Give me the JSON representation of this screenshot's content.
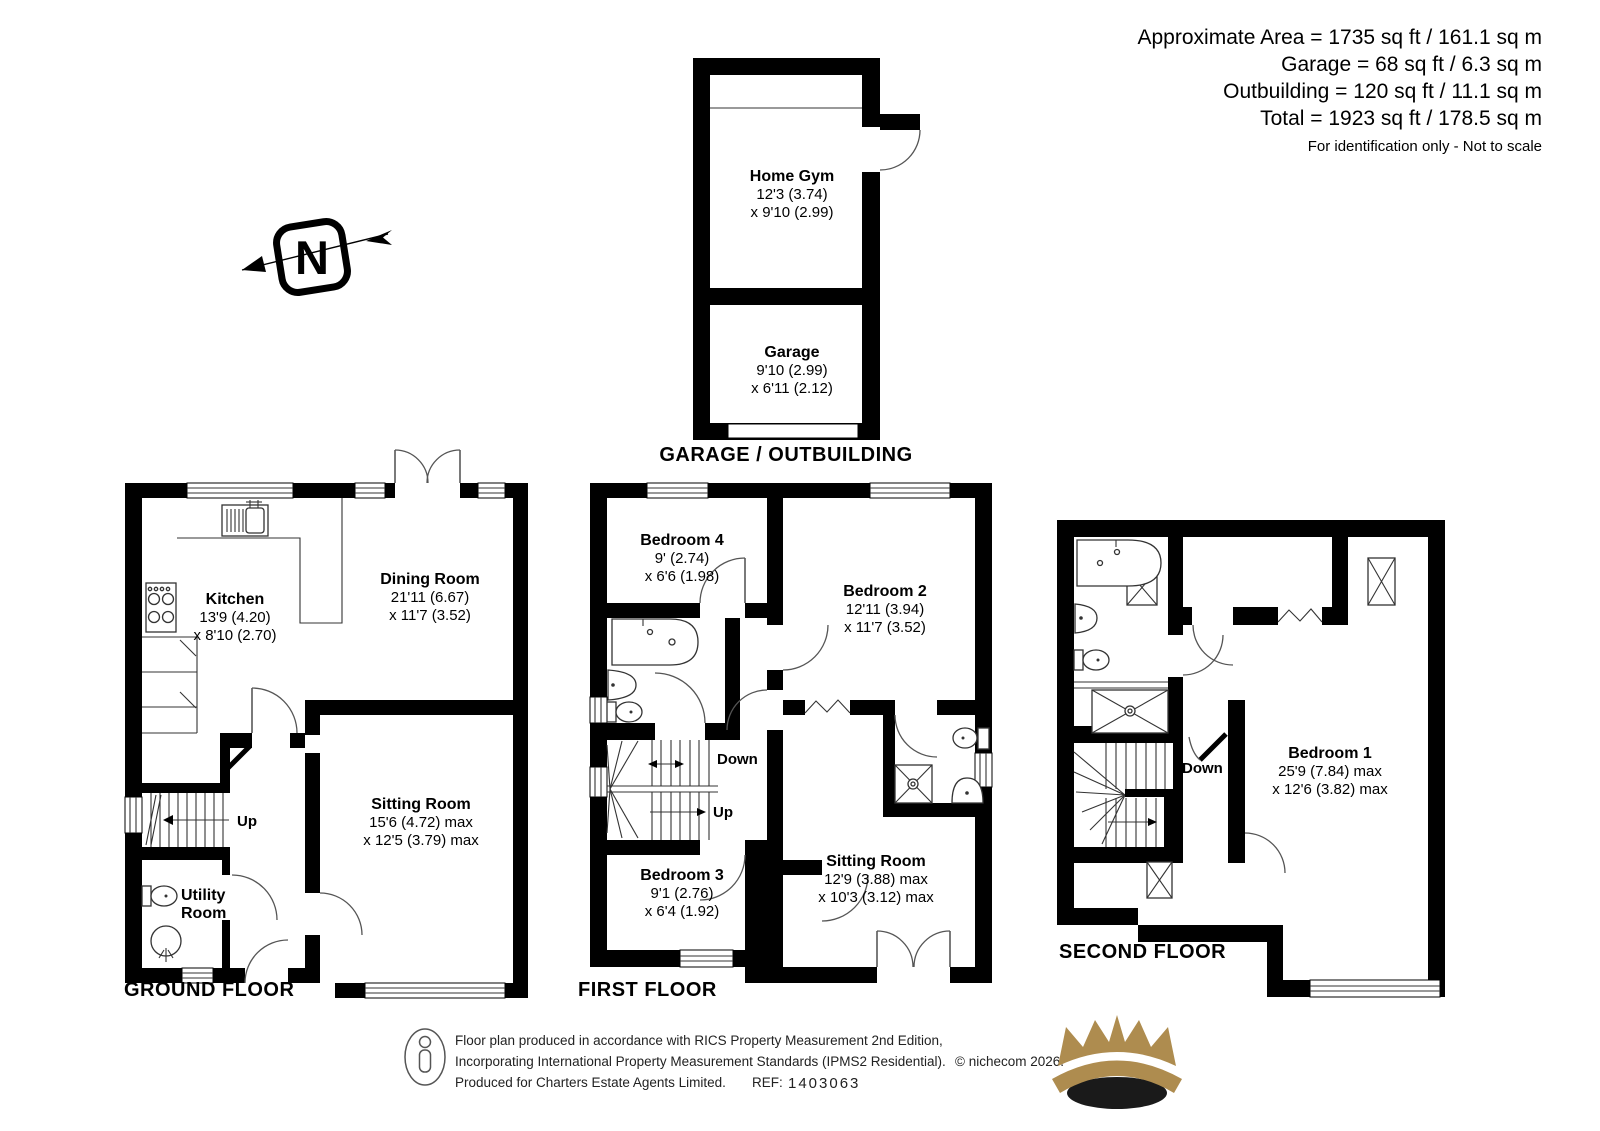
{
  "stats": {
    "line1": "Approximate Area = 1735 sq ft / 161.1 sq m",
    "line2": "Garage = 68 sq ft / 6.3 sq m",
    "line3": "Outbuilding = 120 sq ft / 11.1 sq m",
    "line4": "Total = 1923 sq ft / 178.5 sq m",
    "disclaimer": "For identification only - Not to scale"
  },
  "north_arrow": {
    "label": "N"
  },
  "outbuilding": {
    "title": "GARAGE / OUTBUILDING",
    "home_gym": {
      "name": "Home Gym",
      "dim1": "12'3 (3.74)",
      "dim2": "x 9'10 (2.99)"
    },
    "garage": {
      "name": "Garage",
      "dim1": "9'10 (2.99)",
      "dim2": "x 6'11 (2.12)"
    }
  },
  "ground_floor": {
    "title": "GROUND FLOOR",
    "kitchen": {
      "name": "Kitchen",
      "dim1": "13'9 (4.20)",
      "dim2": "x 8'10 (2.70)"
    },
    "dining_room": {
      "name": "Dining Room",
      "dim1": "21'11 (6.67)",
      "dim2": "x 11'7 (3.52)"
    },
    "sitting_room": {
      "name": "Sitting Room",
      "dim1": "15'6 (4.72) max",
      "dim2": "x 12'5 (3.79) max"
    },
    "utility_room": {
      "line1": "Utility",
      "line2": "Room"
    },
    "up_label": "Up"
  },
  "first_floor": {
    "title": "FIRST FLOOR",
    "bedroom_4": {
      "name": "Bedroom 4",
      "dim1": "9' (2.74)",
      "dim2": "x 6'6 (1.98)"
    },
    "bedroom_2": {
      "name": "Bedroom 2",
      "dim1": "12'11 (3.94)",
      "dim2": "x 11'7 (3.52)"
    },
    "bedroom_3": {
      "name": "Bedroom 3",
      "dim1": "9'1 (2.76)",
      "dim2": "x 6'4 (1.92)"
    },
    "sitting_room": {
      "name": "Sitting Room",
      "dim1": "12'9 (3.88) max",
      "dim2": "x 10'3 (3.12) max"
    },
    "down_label": "Down",
    "up_label": "Up"
  },
  "second_floor": {
    "title": "SECOND FLOOR",
    "bedroom_1": {
      "name": "Bedroom 1",
      "dim1": "25'9 (7.84) max",
      "dim2": "x 12'6 (3.82) max"
    },
    "down_label": "Down"
  },
  "footer": {
    "line1": "Floor plan produced in accordance with RICS Property Measurement 2nd Edition,",
    "line2": "Incorporating International Property Measurement Standards (IPMS2 Residential).",
    "copyright": "© nichecom 2026.",
    "line3": "Produced for Charters Estate Agents Limited.",
    "ref_label": "REF:",
    "ref_number": "1403063"
  },
  "colors": {
    "walls": "#000000",
    "crown_gold": "#AE8C4F",
    "footer_text": "#222222"
  }
}
